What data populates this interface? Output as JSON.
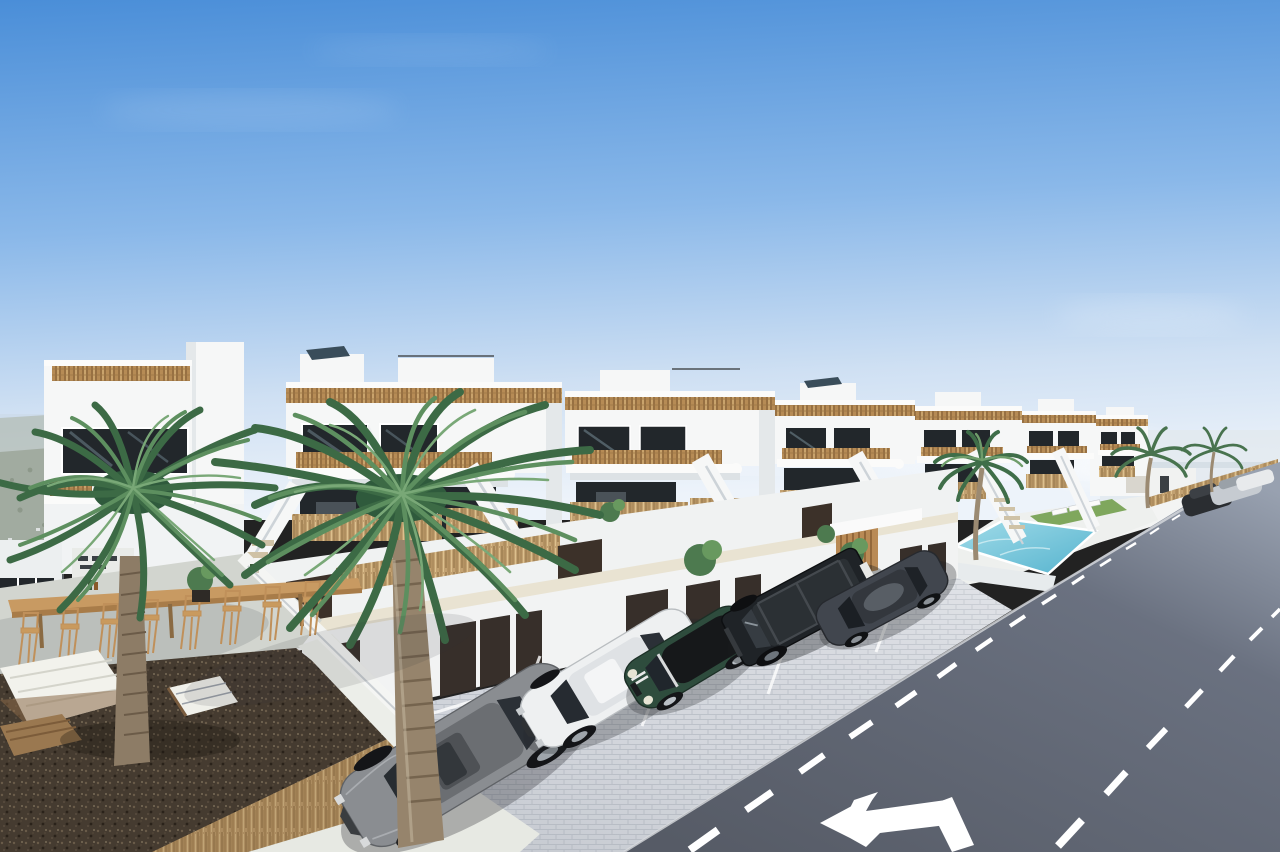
{
  "meta": {
    "title": "Aerial render of new-build white townhouses with parking, communal pool and street",
    "image_type": "architectural-3d-render",
    "width_px": 1280,
    "height_px": 852
  },
  "scene": {
    "sky": {
      "description": "clear blue sky, faint white haze near horizon"
    },
    "background": {
      "left": "hazy olive-green hillside",
      "right": "pale coastal haze with distant palms and parked cars"
    },
    "development": {
      "style": "modern white Mediterranean townhouses",
      "floors": 2,
      "units_visible": 7,
      "features": [
        "roof terraces with cane railings",
        "white balconies with cane infill",
        "external white staircases",
        "ground-floor terraces with brushwood fences",
        "dark brown terrace divider panels",
        "row of garages with dark doors",
        "timber-slat entrance wall",
        "communal pool with loungers and lawn"
      ]
    },
    "pool": {
      "loungers": 3,
      "grass_color": "#7fa75d"
    },
    "road": {
      "lanes": 2,
      "markings": [
        "dashed centre lines",
        "lane-split arrow"
      ],
      "marking_color": "#ffffff"
    },
    "parking": {
      "paving": "light cobblestone",
      "bay_line_color": "#ffffff"
    },
    "cars": [
      {
        "name": "grey-coupe",
        "color": "#8a8d91"
      },
      {
        "name": "white-sedan",
        "color": "#eef0f1"
      },
      {
        "name": "green-mini-convertible",
        "color": "#2e4c3d"
      },
      {
        "name": "black-boxy-suv",
        "color": "#1f2327"
      },
      {
        "name": "dark-grey-sedan",
        "color": "#41464e"
      },
      {
        "name": "distant-parked-cars",
        "count": 3
      }
    ],
    "terrace": {
      "bar_table": {
        "material": "wood",
        "stools": 8
      },
      "lounge": "white cushioned lounge set with timber coffee table",
      "ground": "dark brown gravel with brushwood hedge"
    },
    "palms": {
      "large_foreground": 2,
      "near_pool": 1,
      "distant": 2
    },
    "palette": {
      "sky_top": "#4a8ed8",
      "sky_mid": "#8ab8e9",
      "sky_horizon": "#edf3fa",
      "asphalt_near": "#565b66",
      "asphalt_far": "#98a1b0",
      "pool_light": "#a2dce9",
      "pool_deep": "#55b3ce",
      "paving": "#d7dae0",
      "gravel": "#4e4336",
      "cane": "#b68b55",
      "brushwood": "#c2a171",
      "wall_white": "#f6f7f7",
      "garage_door": "#372f2a",
      "step_stone": "#cfc2a6"
    }
  }
}
